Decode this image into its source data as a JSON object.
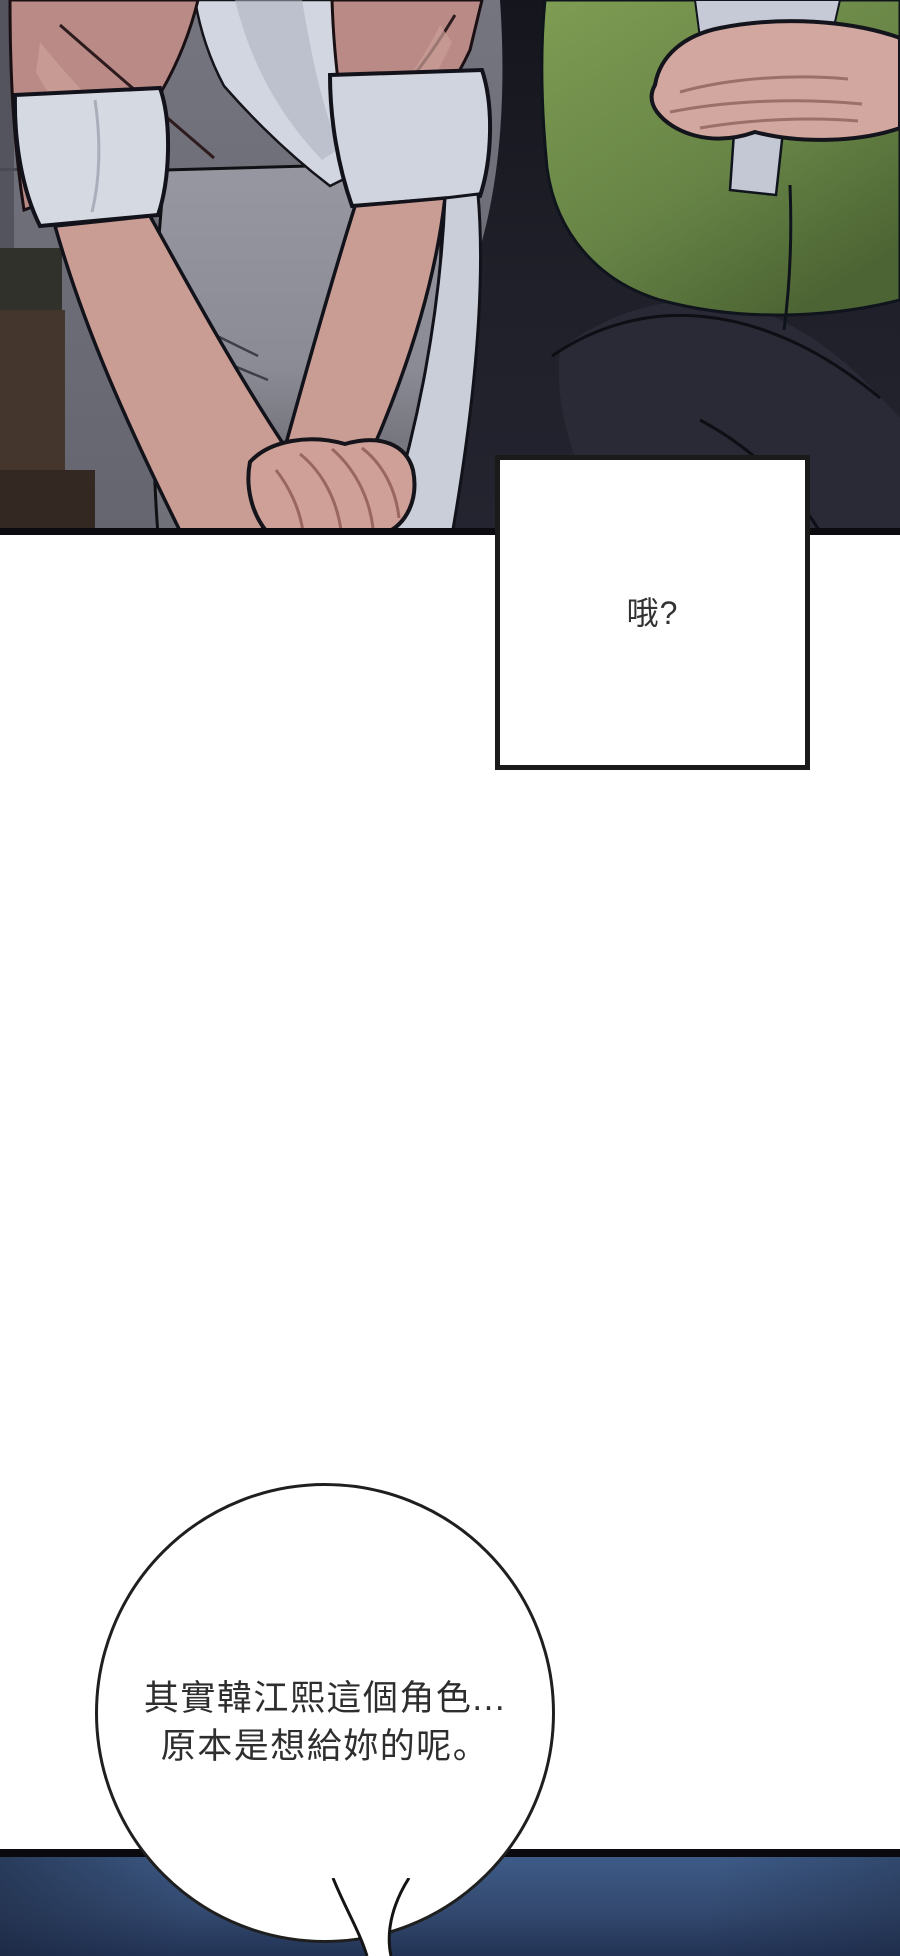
{
  "page": {
    "kind": "vertical webtoon comic page",
    "background": "#ffffff",
    "width_px": 900,
    "height_px": 1956
  },
  "top_panel": {
    "description": "cropped torso illustration: left character in pink cardigan with clasped hands, right character in green sweater vest gesturing",
    "border_color": "#0c0c10",
    "colors": {
      "background_gray": "#6b6b75",
      "wall_strip": "#54545e",
      "charcoal_block": "#31312b",
      "wood_brown": "#44362d",
      "pink_cardigan": "#b98a86",
      "pink_highlight": "#cb9e97",
      "white_shirt": "#d2d6e0",
      "sleeve_cuff": "#d5d9e2",
      "skin": "#cb9e96",
      "gray_skirt": "#94949e",
      "black_jacket": "#191923",
      "green_vest": "#7e9c52",
      "green_vest_dark": "#55713a",
      "dark_pants": "#22222c",
      "hand_skin": "#d2a79f"
    }
  },
  "speech_box": {
    "text": "哦?",
    "fill": "#ffffff",
    "border_color": "#1a1a1a",
    "text_color": "#323232"
  },
  "dialogue_bubble": {
    "lines": [
      "其實韓江熙這個角色...",
      "原本是想給妳的呢。"
    ],
    "fill": "#ffffff",
    "border_color": "#1f1f1f",
    "text_color": "#2e2e2e"
  },
  "bottom_panel": {
    "description": "dark navy panel beginning at page bottom",
    "border_top_color": "#0a0a0e",
    "gradient_top": "#3d5b87",
    "gradient_bottom": "#223355"
  }
}
